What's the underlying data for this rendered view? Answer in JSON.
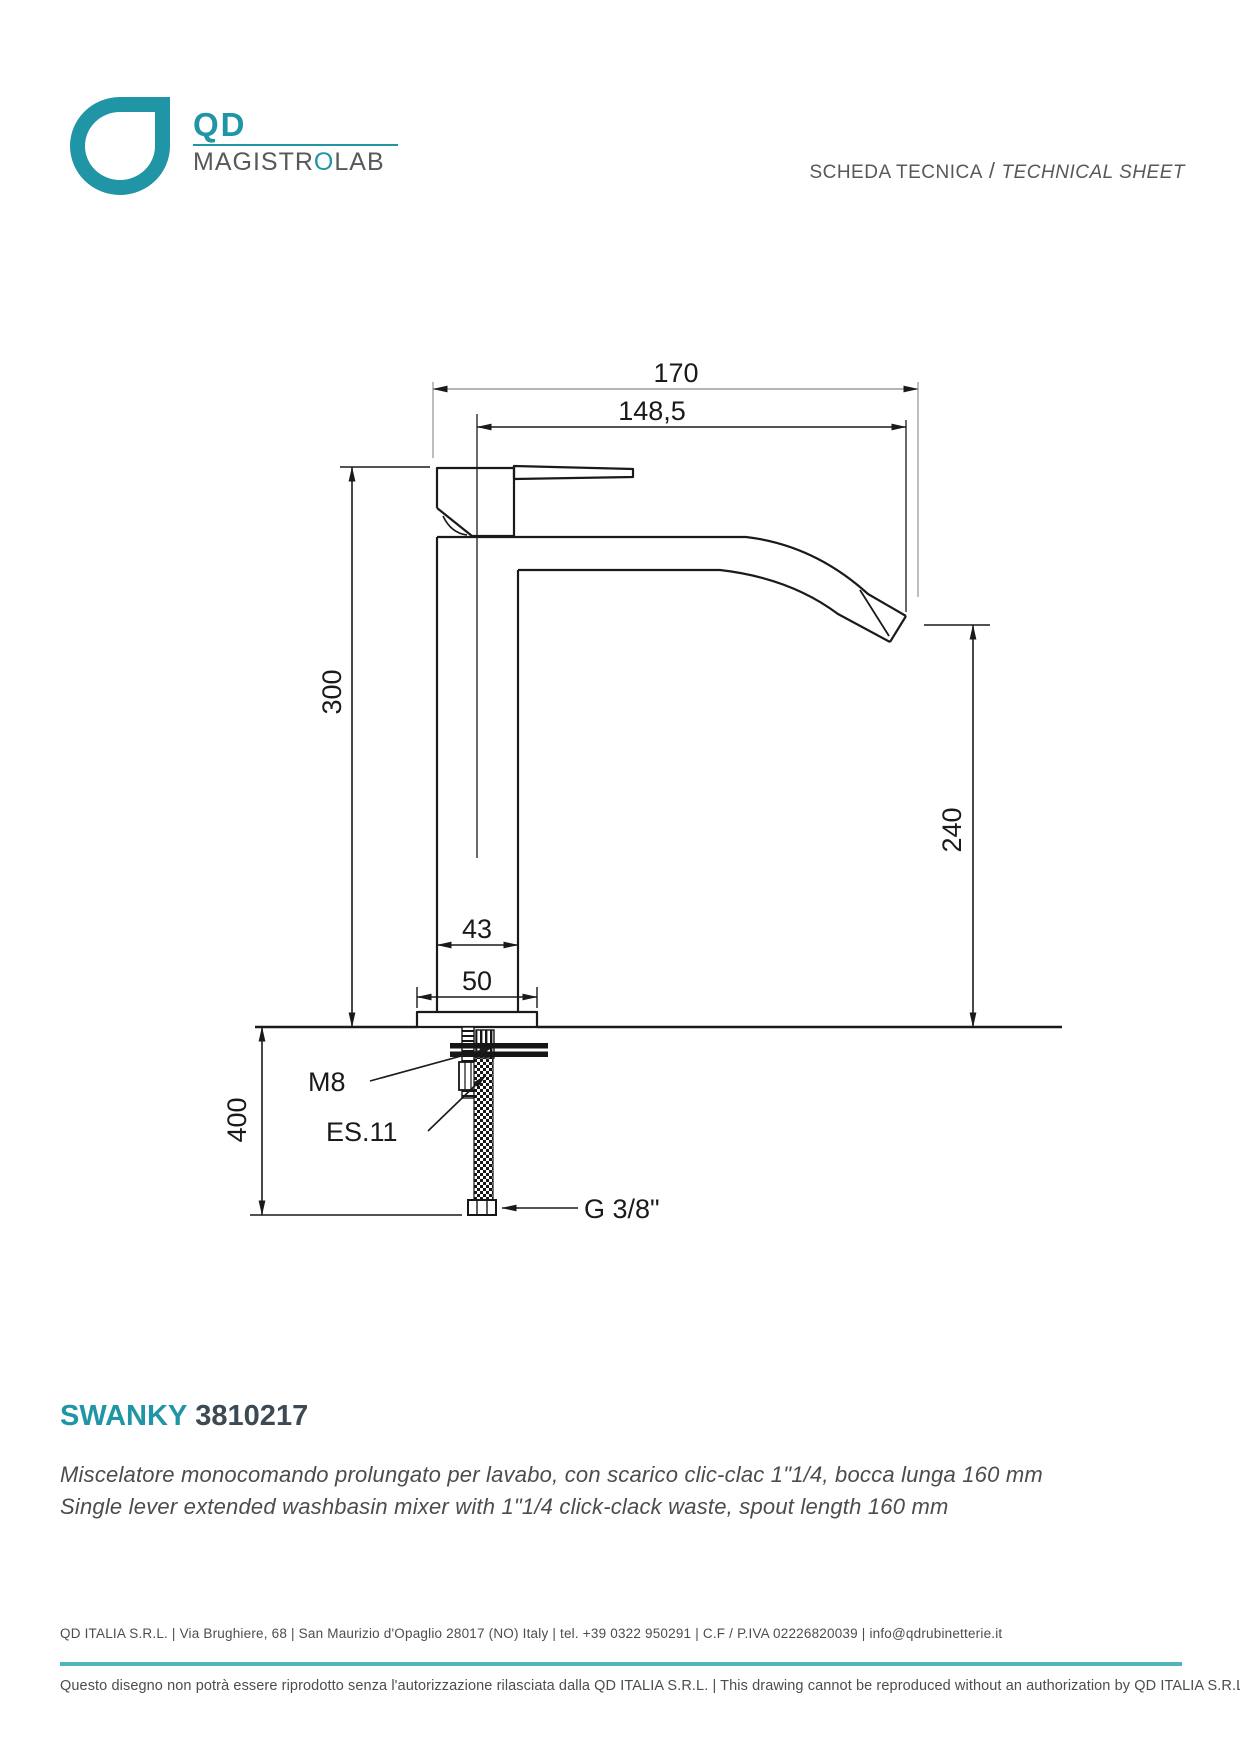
{
  "header": {
    "logo": {
      "qd": "QD",
      "wordmark_pre": "MAGISTR",
      "wordmark_o": "O",
      "wordmark_post": "LAB"
    },
    "sheet_label_it": "SCHEDA TECNICA",
    "sheet_label_sep": "/",
    "sheet_label_en": "TECHNICAL SHEET"
  },
  "drawing": {
    "dims": {
      "total_reach": "170",
      "spout_reach": "148,5",
      "body_height": "300",
      "spout_height": "240",
      "body_width": "43",
      "base_width": "50",
      "under_deck_length": "400"
    },
    "labels": {
      "thread": "M8",
      "hex_key": "ES.11",
      "connection": "G 3/8\""
    }
  },
  "product": {
    "name": "SWANKY",
    "code": "3810217",
    "description_it": "Miscelatore monocomando prolungato per lavabo, con scarico clic-clac 1\"1/4, bocca lunga 160 mm",
    "description_en": "Single lever extended washbasin mixer with 1\"1/4 click-clack waste, spout length 160 mm"
  },
  "footer": {
    "company_line": "QD ITALIA S.R.L. | Via Brughiere, 68 | San Maurizio d'Opaglio 28017 (NO) Italy | tel. +39 0322 950291 | C.F / P.IVA 02226820039 | info@qdrubinetterie.it",
    "disclaimer": "Questo disegno non potrà essere riprodotto senza l'autorizzazione rilasciata dalla QD ITALIA S.R.L. | This drawing cannot be reproduced without an authorization by QD ITALIA S.R.L."
  },
  "colors": {
    "teal": "#2095a5",
    "rule_teal": "#4fb5ba",
    "text_gray": "#58595b",
    "line_black": "#1a1a1a",
    "line_gray": "#9b9b9b"
  }
}
